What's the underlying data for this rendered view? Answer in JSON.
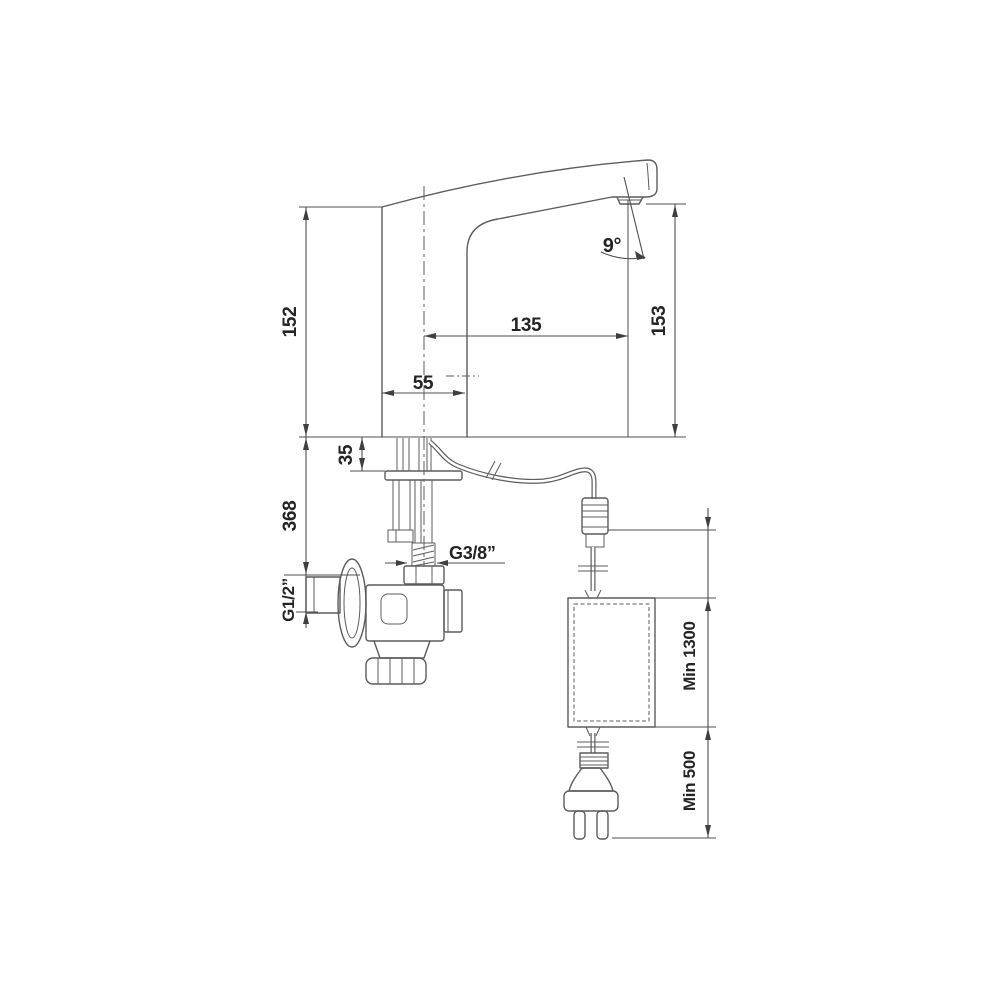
{
  "drawing": {
    "type": "technical-drawing",
    "subject": "sensor faucet with angle valve, power supply unit and mains plug - installation dimensions",
    "background_color": "#ffffff",
    "line_color": "#5c5c5c",
    "text_color": "#242424",
    "labels": {
      "body_height": "152",
      "spout_reach": "135",
      "outlet_height": "153",
      "jet_angle": "9°",
      "base_width": "55",
      "deck_thickness": "35",
      "supply_depth": "368",
      "outlet_thread": "G3/8”",
      "inlet_thread": "G1/2”",
      "cable_min_length": "Min 1300",
      "cord_min_length": "Min 500"
    }
  }
}
